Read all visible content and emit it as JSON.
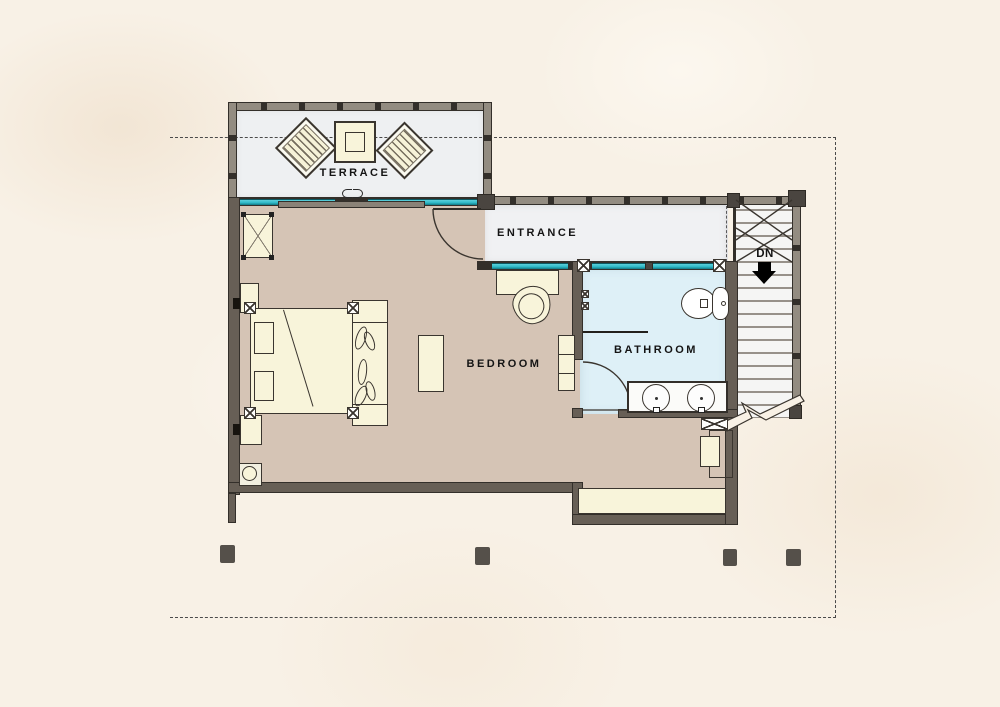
{
  "rooms": {
    "terrace": {
      "label": "TERRACE"
    },
    "entrance": {
      "label": "ENTRANCE"
    },
    "bedroom": {
      "label": "BEDROOM"
    },
    "bathroom": {
      "label": "BATHROOM"
    }
  },
  "stairs": {
    "direction_label": "DN",
    "arrow_icon": "down-arrow"
  },
  "colors": {
    "canvas_bg": "#f8f1e6",
    "floor_bedroom": "#d5c4b5",
    "floor_bathroom": "#def0f7",
    "floor_terrace": "#eef0f2",
    "floor_entrance": "#f0f1f3",
    "wall_fill": "#675f56",
    "wall_edge": "#332f2a",
    "rail_fill": "#938c81",
    "glazing": "#2fb9c7",
    "glazing_dark": "#117884",
    "furniture_fill": "#f8f4da",
    "furniture_edge": "#3a352f",
    "stair_tread": "#f5f5f4",
    "stair_line": "#97918a",
    "label_ink": "#141414",
    "boundary_ink": "#4a4a4a",
    "column_ink": "#55504a"
  },
  "icons": [
    "lounge-chair-icon",
    "coffee-table-icon",
    "sliding-door-icon",
    "door-swing-icon",
    "armchair-icon",
    "dresser-icon",
    "double-bed-icon",
    "pillow-icon",
    "nightstand-icon",
    "ottoman-icon",
    "desk-icon",
    "desk-chair-icon",
    "shelf-icon",
    "cabinet-icon",
    "stool-icon",
    "toilet-icon",
    "vanity-sink-icon",
    "shower-valve-icon",
    "wardrobe-icon",
    "window-seat-icon",
    "staircase-icon",
    "down-arrow",
    "column-footing",
    "break-line-icon",
    "property-line"
  ]
}
